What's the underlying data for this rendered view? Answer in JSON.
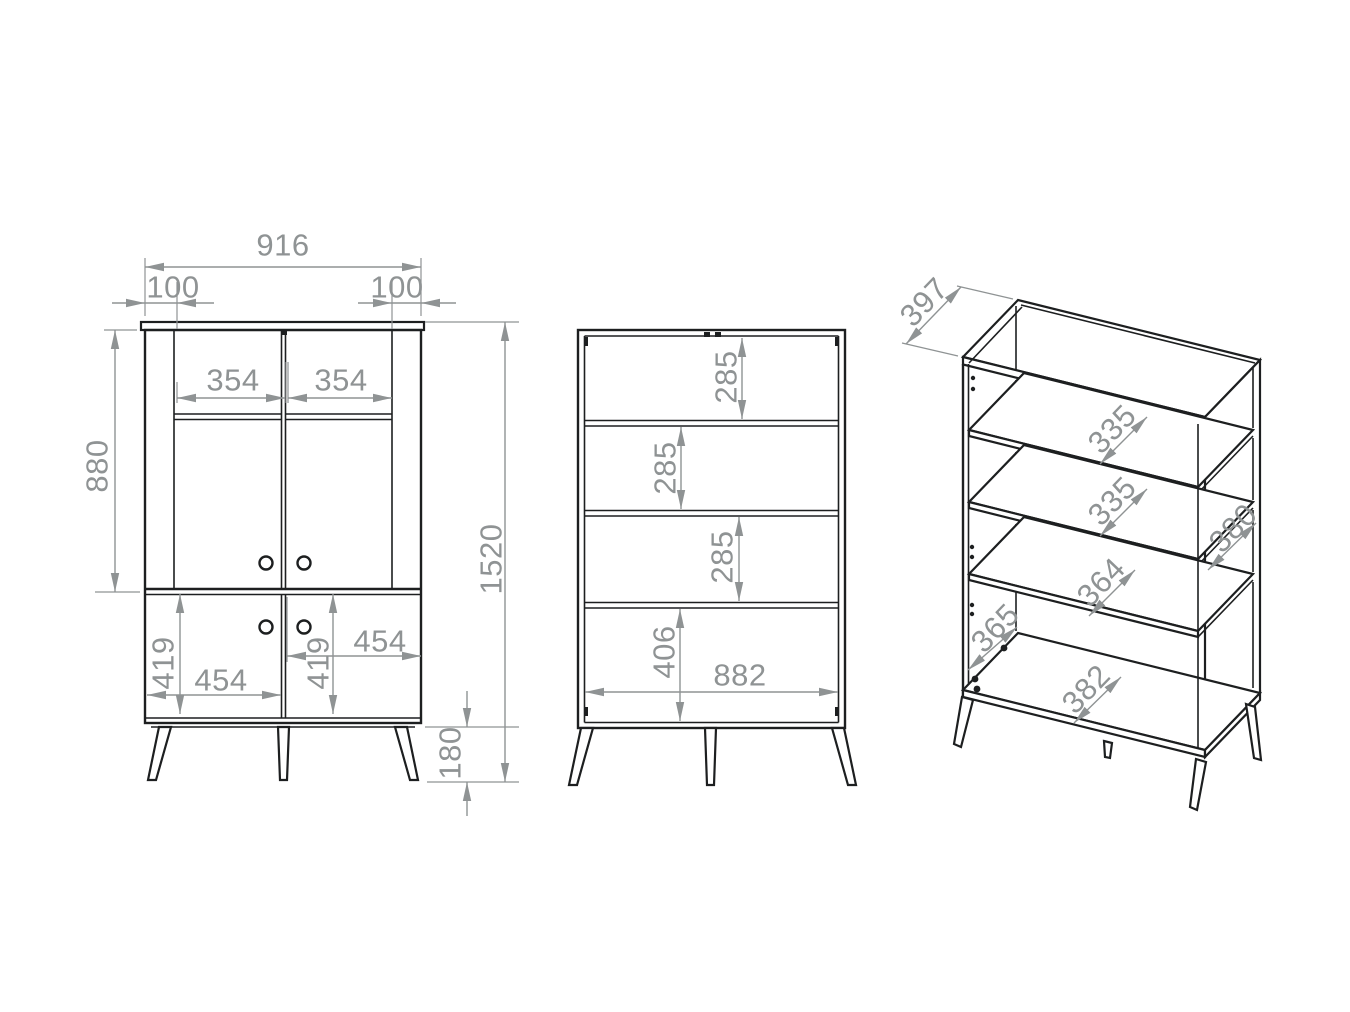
{
  "colors": {
    "background": "#ffffff",
    "outline": "#1d1f20",
    "dimension": "#8f9394"
  },
  "front": {
    "total_width": "916",
    "left_inset": "100",
    "right_inset": "100",
    "left_glass_width": "354",
    "right_glass_width": "354",
    "upper_section_height": "880",
    "total_height": "1520",
    "left_door_height": "419",
    "left_door_width": "454",
    "right_door_height": "419",
    "right_door_width": "454",
    "leg_height": "180"
  },
  "section": {
    "compartment_1": "285",
    "compartment_2": "285",
    "compartment_3": "285",
    "bottom_compartment": "406",
    "interior_width": "882"
  },
  "isometric": {
    "top_depth": "397",
    "shelf_1_depth": "335",
    "shelf_2_depth": "335",
    "right_side_depth": "380",
    "shelf_3_depth": "364",
    "interior_depth": "365",
    "bottom_depth": "382"
  }
}
